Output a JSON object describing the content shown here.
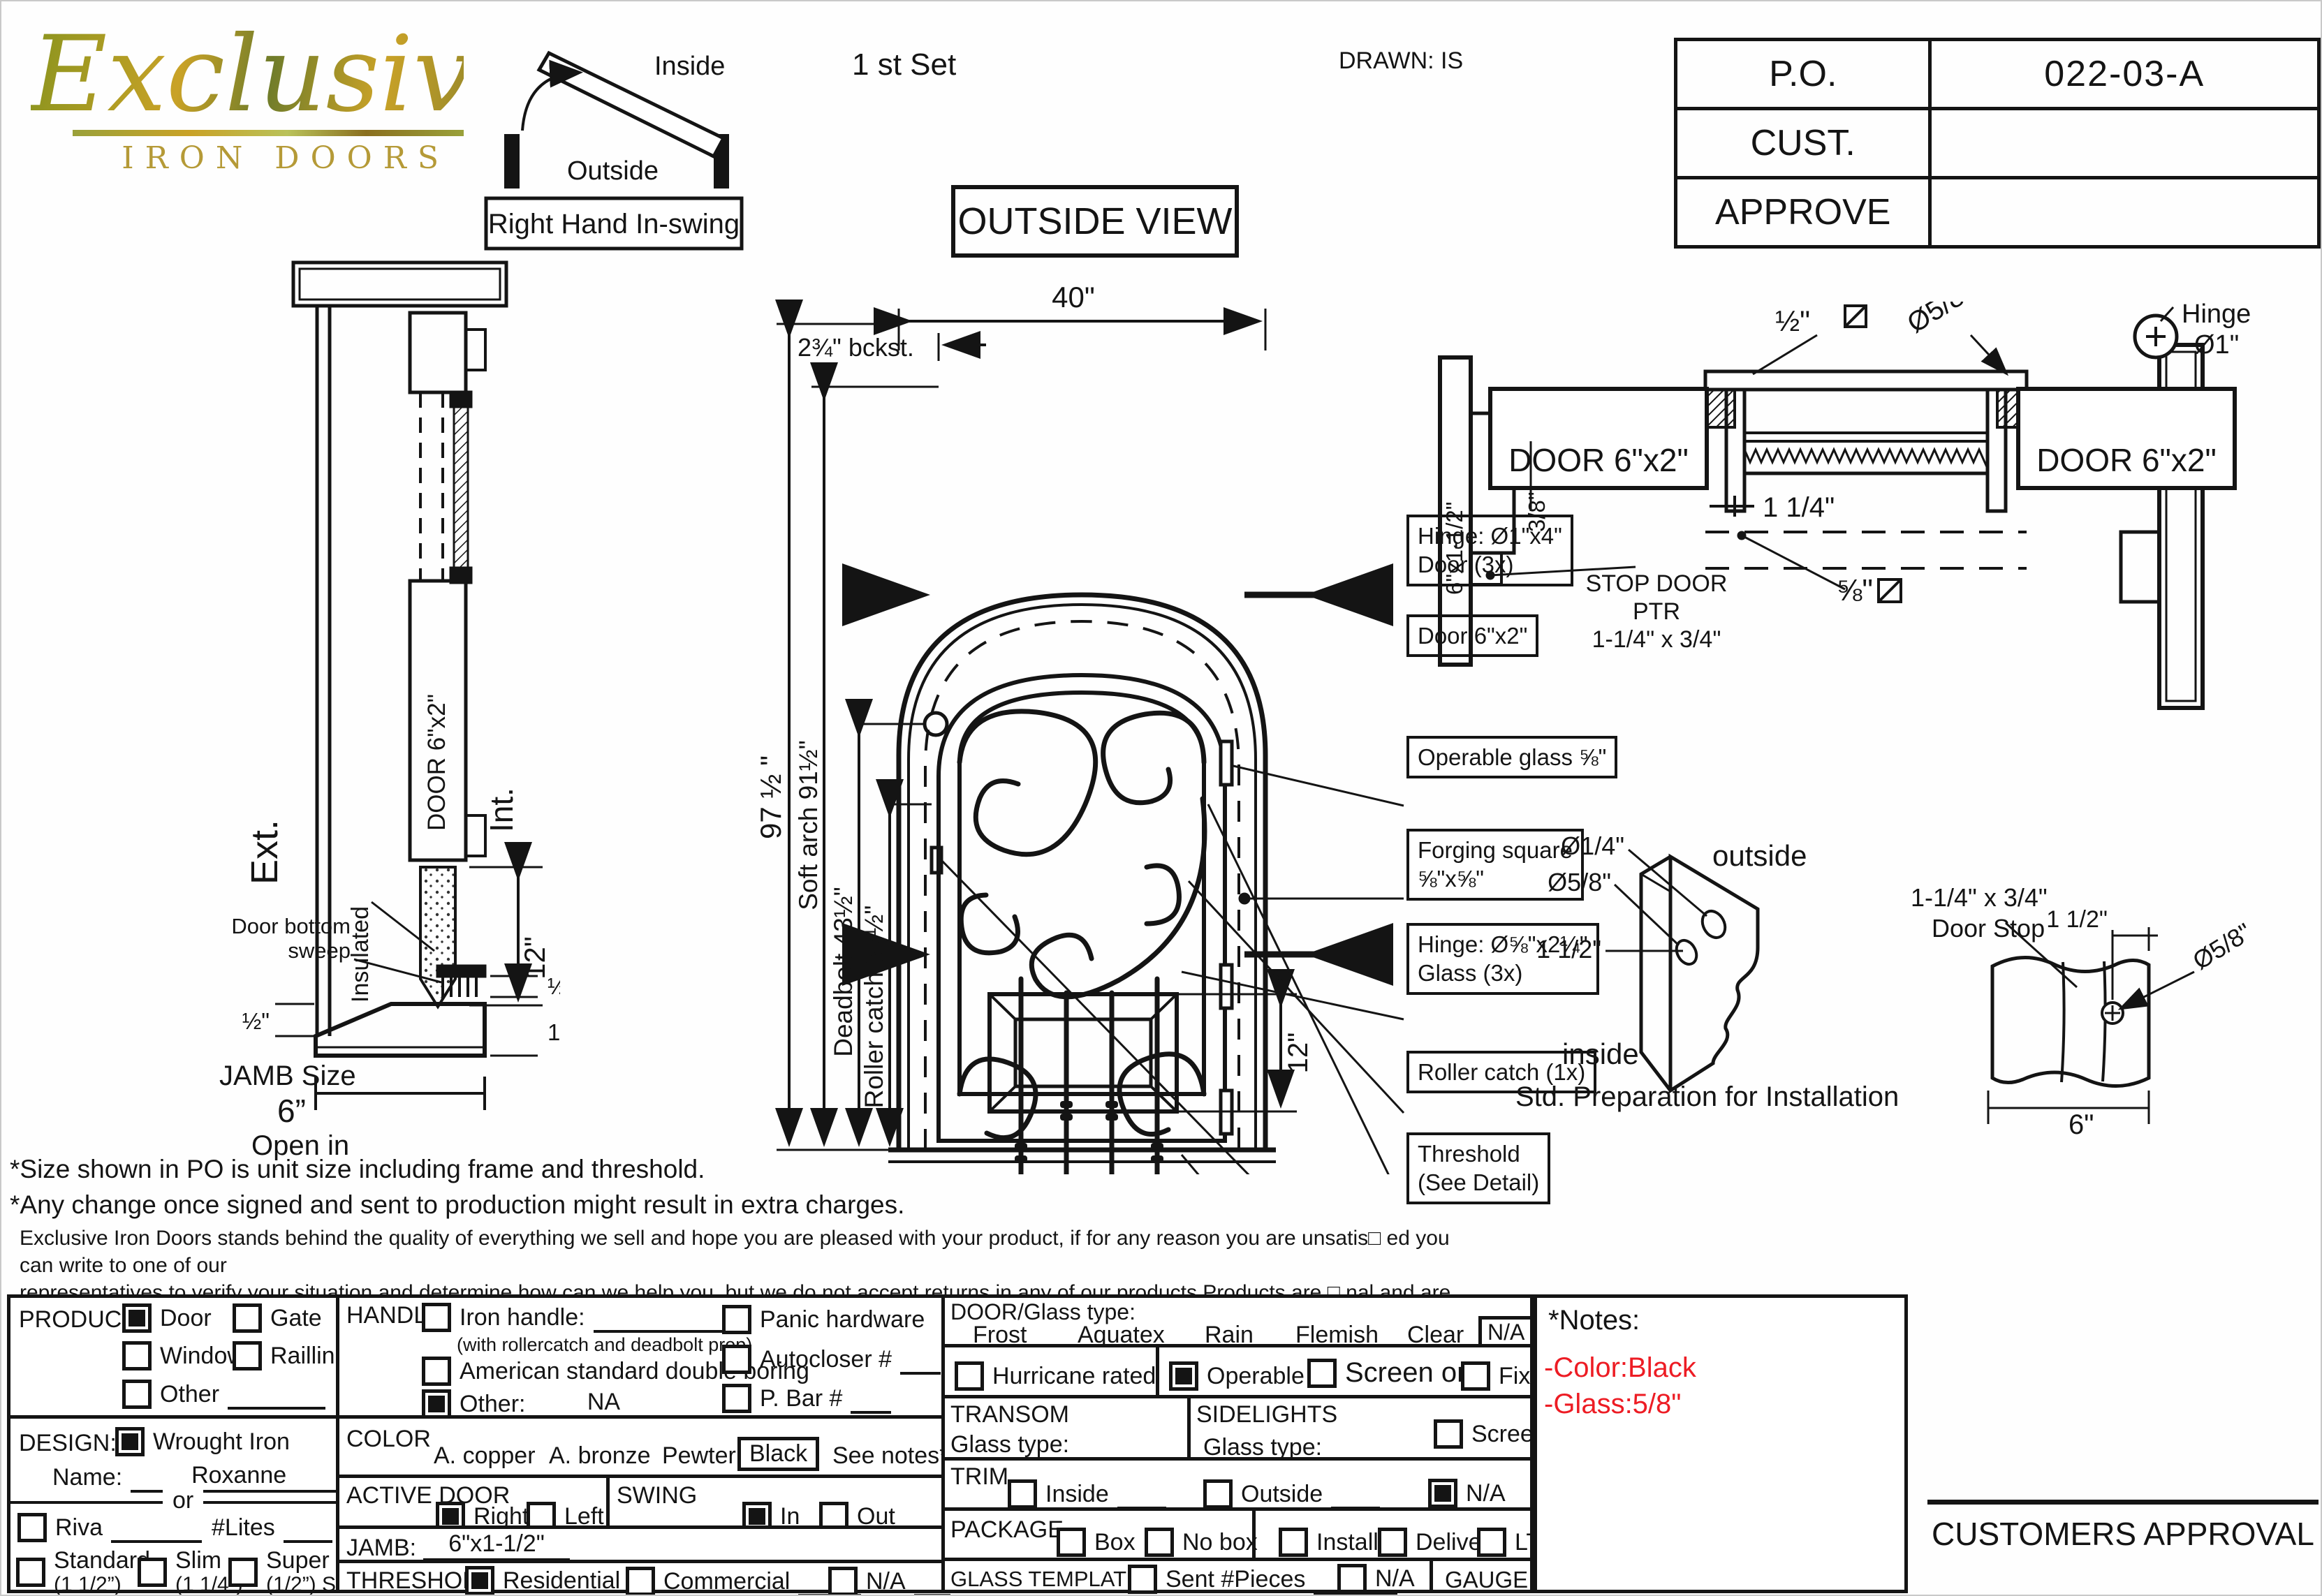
{
  "header": {
    "logo_script": "Exclusive",
    "logo_sub": "IRON DOORS",
    "swing": {
      "inside": "Inside",
      "outside": "Outside",
      "label": "Right Hand In-swing"
    },
    "set_label": "1 st Set",
    "drawn": "DRAWN: IS",
    "outside_view": "OUTSIDE VIEW",
    "po": {
      "po_label": "P.O.",
      "po_value": "022-03-A",
      "cust_label": "CUST.",
      "cust_value": "",
      "approve_label": "APPROVE",
      "approve_value": ""
    }
  },
  "jamb": {
    "ext": "Ext.",
    "int": "Int.",
    "door": "DOOR 6\"x2\"",
    "dim_12": "12\"",
    "insulated": "Insulated",
    "sweep_1": "Door bottom",
    "sweep_2": "sweep",
    "dim_half_left": "½\"",
    "dim_half_right": "½\"",
    "dim_one_half": "1½\"",
    "jamb_size": "JAMB Size",
    "jamb_value": "6”",
    "open_in": "Open in"
  },
  "door": {
    "dim_40": "40\"",
    "backset": "2¾\" bckst.",
    "dim_97": "97 ½ \"",
    "dim_arch": "Soft arch 91½\"",
    "dim_deadbolt": "Deadbolt 43½\"",
    "dim_roller": "Roller catch 37½\"",
    "dim_12": "12\"",
    "callout_hinge_door_1": "Hinge: Ø1\"x4\"",
    "callout_hinge_door_2": "Door (3x)",
    "callout_door": "Door 6\"x2\"",
    "callout_glass": "Operable glass ⅝\"",
    "callout_forging_1": "Forging square",
    "callout_forging_2": "⅝\"x⅝\"",
    "callout_hinge_glass_1": "Hinge: Ø⅝\"x2¼\"",
    "callout_hinge_glass_2": "Glass (3x)",
    "callout_roller": "Roller catch  (1x)",
    "callout_threshold_1": "Threshold",
    "callout_threshold_2": "(See Detail)"
  },
  "head": {
    "door_left": "DOOR 6\"x2\"",
    "door_right": "DOOR 6\"x2\"",
    "jamb_plate": "6\"x1-1/2\"",
    "dim_38": "3/8\"",
    "dim_half_sq": "½\"",
    "dia_58": "Ø5/8\"",
    "dim_114": "1 1/4\"",
    "dim_58_sq": "⅝\"",
    "stop_1": "STOP DOOR",
    "stop_2": "PTR",
    "stop_3": "1-1/4\" x 3/4\"",
    "hinge": "Hinge",
    "hinge_dia": "Ø1\""
  },
  "prep": {
    "dia_14": "Ø1/4\"",
    "dia_58": "Ø5/8\"",
    "dim_112": "1 1/2\"",
    "outside": "outside",
    "inside": "inside",
    "caption": "Std. Preparation for Installation"
  },
  "stop": {
    "size": "1-1/4\" x 3/4\"",
    "name": "Door Stop",
    "dim_112": "1 1/2\"",
    "dia_58": "Ø5/8\"",
    "dim_6": "6\""
  },
  "disclaimer": {
    "line1": "*Size shown in PO is unit size including frame and threshold.",
    "line2": "*Any change once signed and sent to production might result in extra charges.",
    "para1": "Exclusive Iron Doors stands behind the quality of everything we sell and hope you are pleased with your product, if for any reason you are unsatis□ ed you can write to one of our",
    "para2": "representatives to verify your situation and determine how can we help you, but we do not accept returns in any of our products.Products are □ nal and are not eligible for returns, changes",
    "para3": "or alterations.By signing you agree to our terms and conditions, delivery pdf and forms of payment. *Doors measurements do not include the gaps between jambs"
  },
  "form": {
    "product": {
      "label": "PRODUCT:",
      "door": "Door",
      "gate": "Gate",
      "window": "Window",
      "railing": "Railling",
      "other": "Other"
    },
    "design": {
      "label": "DESIGN:",
      "wrought": "Wrought Iron",
      "name_label": "Name:",
      "name_value": "Roxanne",
      "or": "or",
      "riva": "Riva",
      "lites": "#Lites",
      "standard": "Standard",
      "standard_sub": "(1 1/2”)",
      "slim": "Slim",
      "slim_sub": "(1 1/4”)",
      "super": "Super Slim",
      "super_sub": "(1/2”) SDL"
    },
    "handle": {
      "label": "HANDLE",
      "iron": "Iron handle:",
      "iron_sub": "(with rollercatch and deadbolt prep)",
      "american": "American standard double boring",
      "other": "Other:",
      "other_value": "NA",
      "panic": "Panic hardware",
      "autocloser": "Autocloser #",
      "pbar": "P. Bar #"
    },
    "color": {
      "label": "COLOR",
      "copper": "A. copper",
      "bronze": "A. bronze",
      "pewter": "Pewter",
      "black": "Black",
      "see_notes": "See notes*"
    },
    "active": {
      "label": "ACTIVE DOOR",
      "right": "Right",
      "left": "Left"
    },
    "swing": {
      "label": "SWING",
      "in": "In",
      "out": "Out"
    },
    "jamb": {
      "label": "JAMB:",
      "value": "6\"x1-1/2\""
    },
    "threshold": {
      "label": "THRESHOLD",
      "residential": "Residential",
      "commercial": "Commercial",
      "na": "N/A"
    },
    "glasstype": {
      "label": "DOOR/Glass type:",
      "frost": "Frost",
      "aquatex": "Aquatex",
      "rain": "Rain",
      "flemish": "Flemish",
      "clear": "Clear",
      "na": "N/A"
    },
    "hurricane": {
      "label": "Hurricane rated"
    },
    "operable": {
      "operable": "Operable",
      "screen_or": "Screen or",
      "fixed": "Fixed"
    },
    "transom": {
      "label": "TRANSOM",
      "glass": "Glass type:"
    },
    "sidelights": {
      "label": "SIDELIGHTS",
      "glass": "Glass type:",
      "screen": "Screen"
    },
    "trim": {
      "label": "TRIM",
      "inside": "Inside",
      "outside": "Outside",
      "na": "N/A"
    },
    "package": {
      "label": "PACKAGE",
      "box": "Box",
      "nobox": "No box",
      "install": "Install",
      "delivery": "Delivery",
      "ltl": "LTL"
    },
    "template": {
      "label": "GLASS TEMPLATE",
      "sent": "Sent #Pieces",
      "na": "N/A",
      "gauge": "GAUGE: 14"
    }
  },
  "notes": {
    "title": "*Notes:",
    "color": "-Color:Black",
    "glass": "-Glass:5/8\"",
    "accent": "#ed1c24"
  },
  "approval": "CUSTOMERS APPROVAL"
}
